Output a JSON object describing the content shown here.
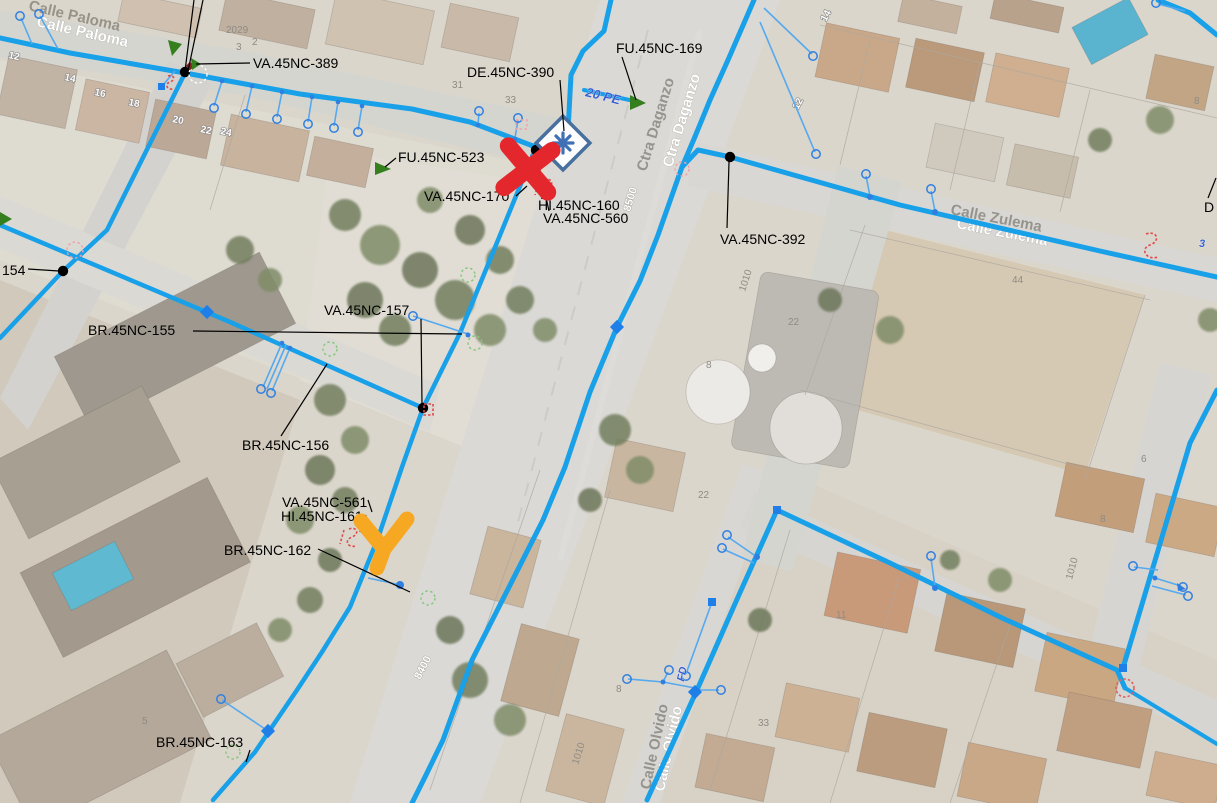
{
  "app": "gis-water-network-map-viewer",
  "streets": [
    "Calle Paloma",
    "Ctra Daganzo",
    "Calle Zulema",
    "Calle Olvido"
  ],
  "labels": [
    {
      "text": "VA.45NC-389"
    },
    {
      "text": "DE.45NC-390"
    },
    {
      "text": "FU.45NC-169"
    },
    {
      "text": "FU.45NC-523"
    },
    {
      "text": "VA.45NC-170"
    },
    {
      "text": "HI.45NC-160"
    },
    {
      "text": "VA.45NC-560"
    },
    {
      "text": "VA.45NC-392"
    },
    {
      "text": "154"
    },
    {
      "text": "BR.45NC-155"
    },
    {
      "text": "VA.45NC-157"
    },
    {
      "text": "BR.45NC-156"
    },
    {
      "text": "VA.45NC-561"
    },
    {
      "text": "HI.45NC-161"
    },
    {
      "text": "BR.45NC-162"
    },
    {
      "text": "BR.45NC-163"
    },
    {
      "text": "D"
    }
  ],
  "pipe_annotations": [
    "20 PE",
    "8500",
    "8400",
    "FD",
    "3"
  ],
  "house_numbers": [
    "12",
    "14",
    "16",
    "18",
    "20",
    "22",
    "24",
    "2029",
    "3",
    "2",
    "31",
    "33",
    "14",
    "12",
    "8",
    "44",
    "1010",
    "22",
    "8",
    "22",
    "11",
    "8",
    "6",
    "1010",
    "8",
    "33",
    "1010",
    "5"
  ],
  "markers": {
    "red_x": {
      "name": "red-x-marker",
      "color": "#E4272C"
    },
    "orange_check": {
      "name": "orange-check-marker",
      "color": "#F6A823"
    }
  },
  "colors": {
    "pipe_main": "#18A0E8",
    "pipe_service": "#55A9EE",
    "node_blue": "#1F7FE8",
    "fountain_green": "#357F1F",
    "hydrant_red": "#E04848",
    "de_symbol": "#3F6FB5",
    "label_text": "#000000"
  }
}
